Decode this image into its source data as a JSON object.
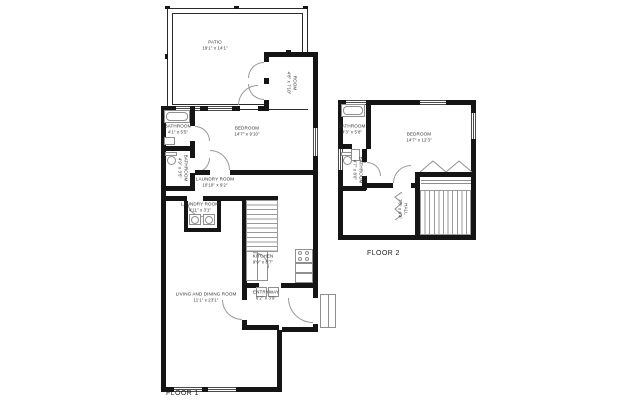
{
  "colors": {
    "wall": "#151515",
    "line": "#8f8f8f",
    "text": "#2f2f2f",
    "background": "#ffffff"
  },
  "floor1": {
    "caption": "FLOOR 1",
    "rooms": {
      "patio": {
        "name": "PATIO",
        "dims": "19'1\" x 14'1\""
      },
      "side_room": {
        "name": "ROOM",
        "dims": "4'8\" x 7'10\""
      },
      "bathroom": {
        "name": "BATHROOM",
        "dims": "4'1\" x 5'5\""
      },
      "bathroom2": {
        "name": "BATHROOM",
        "dims": "4'9\" x 3'5\""
      },
      "bedroom": {
        "name": "BEDROOM",
        "dims": "14'7\" x 9'10\""
      },
      "laundry_room": {
        "name": "LAUNDRY ROOM",
        "dims": "10'10\" x 9'2\""
      },
      "laundry_room_2": {
        "name": "LAUNDRY ROOM",
        "dims": "4'11\" x 3'1\""
      },
      "kitchen": {
        "name": "KITCHEN",
        "dims": "9'9\" x 8'7\""
      },
      "entryway": {
        "name": "ENTRYWAY",
        "dims": "6'2\" x 3'9\""
      },
      "living_dining": {
        "name": "LIVING AND DINING ROOM",
        "dims": "11'1\" x 23'1\""
      }
    }
  },
  "floor2": {
    "caption": "FLOOR 2",
    "rooms": {
      "bathroom": {
        "name": "BATHROOM",
        "dims": "4'3\" x 5'8\""
      },
      "bathroom2": {
        "name": "BATHROOM",
        "dims": "4'7\" x 8'6\""
      },
      "bedroom": {
        "name": "BEDROOM",
        "dims": "14'7\" x 12'3\""
      },
      "hall": {
        "name": "HALL",
        "dims": "7'8\" x 6'4\""
      }
    }
  }
}
